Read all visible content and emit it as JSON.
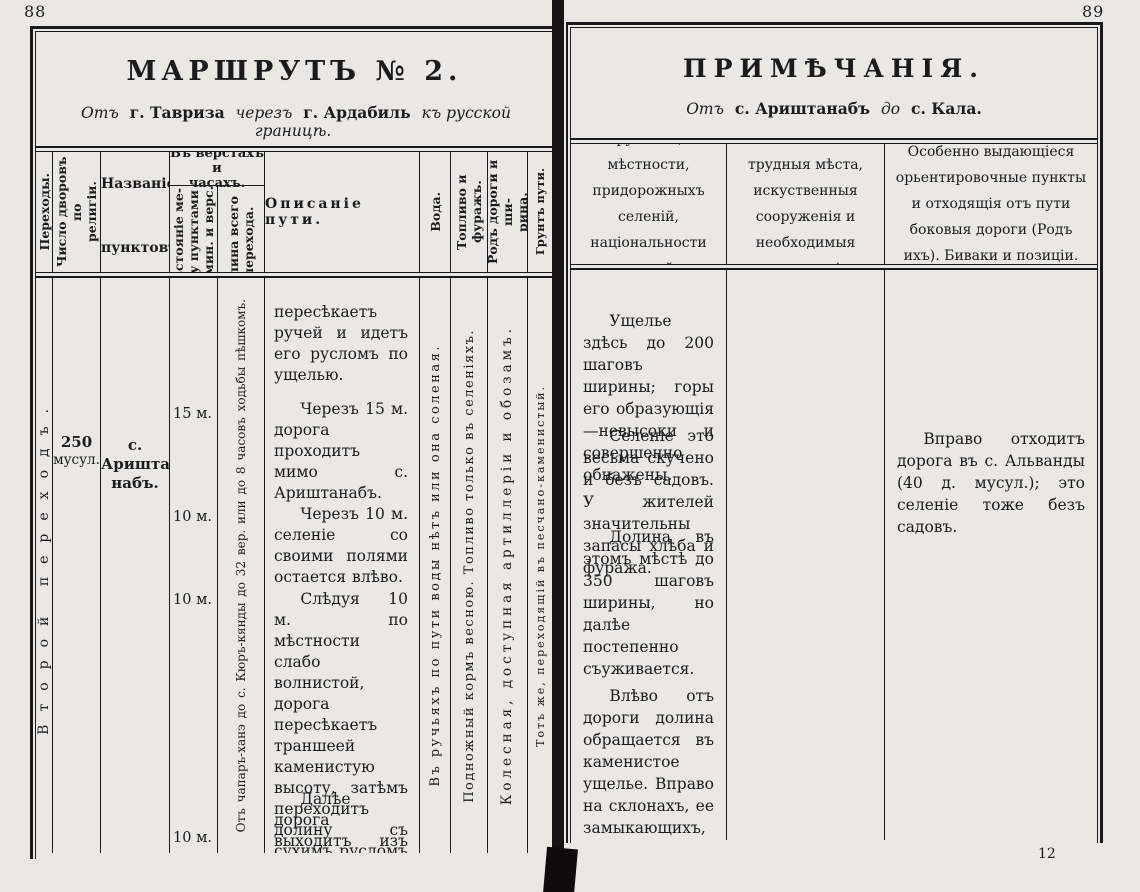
{
  "left_page": {
    "page_number": "88",
    "title": "МАРШРУТЪ № 2.",
    "subtitle": {
      "from_word": "Отъ",
      "from_place": "г. Тавриза",
      "via_word": "черезъ",
      "via_place": "г. Ардабиль",
      "to_phrase": "къ русской границѣ."
    },
    "headers": {
      "transitions": "Переходы.",
      "households": "Число дворовъ по\nрелигіи.",
      "point_names": "Названіе\nпунктовъ.",
      "versts_group": "Въ верстахъ и\nчасахъ.",
      "distance_between": "Разстояніе ме-\nжду пунктами\nвъ мин. и верс.",
      "total_length": "Длина всего\nперехода.",
      "route_description": "Описаніе пути.",
      "water": "Вода.",
      "fuel_forage": "Топливо и фуражъ.",
      "road_type": "Родъ дороги и ши-\nрина.",
      "surface": "Грунтъ пути."
    },
    "body": {
      "transition_name": "Второй переходъ.",
      "households_count": "250",
      "households_note": "мусул.",
      "point_name": "с. Аришта-\nнабъ.",
      "distances": [
        "15 м.",
        "10 м.",
        "10 м.",
        "10 м."
      ],
      "total_length_note": "Отъ чапаръ-ханэ до с. Кюръ-кянды до 32 вер. или до 8 часовъ ходьбы пѣшкомъ.",
      "route_paragraphs": [
        "пересѣкаетъ ручей и идетъ его русломъ по ущелью.",
        "Черезъ 15 м. дорога проходитъ мимо с. Ариштанабъ.",
        "Черезъ 10 м. селеніе со своими полями остается влѣво.",
        "Слѣдуя 10 м. по мѣстности слабо волнистой, дорога пересѣкаетъ траншеей каменистую высоту, затѣмъ переходитъ долину съ сухимъ русломъ ручья.",
        "Далѣе дорога выходитъ изъ долины и въ общемъ черезъ 10 м."
      ],
      "water_note": "Въ ручьяхъ по пути воды нѣтъ или она соленая.",
      "fuel_note": "Подножный кормъ весною. Топливо только въ селеніяхъ.",
      "road_note": "Колесная, доступная артиллеріи и обозамъ.",
      "surface_note": "Тотъ же, переходящій въ песчано-каменистый."
    }
  },
  "right_page": {
    "page_number": "89",
    "title": "ПРИМѢЧАНІЯ.",
    "subtitle": {
      "from_word": "Отъ",
      "from_place": "с. Ариштанабъ",
      "to_word": "до",
      "to_place": "с. Кала."
    },
    "headers": {
      "col1": "Свойство окружающей мѣстности, придорожныхъ селеній, національности жителей и занятія ихъ.",
      "col2": "Наиболѣе трудныя мѣста, искуственныя сооруженія и необходимыя исправленія.",
      "col3": "Особенно выдающіеся орьентировочные пункты и отходящія отъ пути боковыя дороги (Родъ ихъ). Биваки и позиціи."
    },
    "col1_paragraphs": [
      "Ущелье здѣсь до 200 шаговъ ширины; горы его образующія—невысоки и совершенно обнажены.",
      "Селеніе это весьма скучено и безъ садовъ. У жителей значительны запасы хлѣба и фуража.",
      "Долина въ этомъ мѣстѣ до 350 шаговъ ширины, но далѣе постепенно съуживается.",
      "Влѣво отъ дороги долина обращается въ каменистое ущелье. Вправо на склонахъ, ее замыкающихъ, видно с. Гямбага (на картѣ Джамбага)."
    ],
    "col3_paragraphs": [
      "Вправо отходитъ дорога въ с. Альванды (40 д. мусул.); это селеніе тоже безъ садовъ."
    ],
    "signature_mark": "12"
  }
}
